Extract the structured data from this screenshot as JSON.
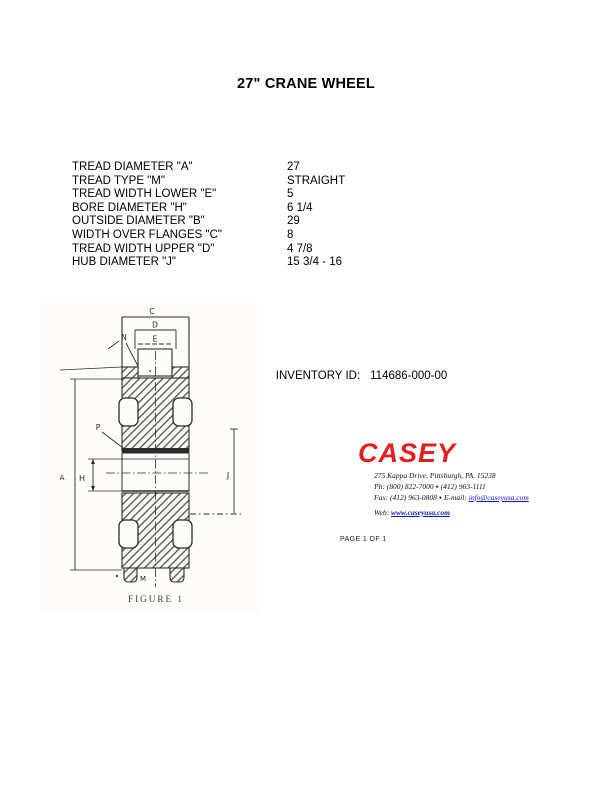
{
  "page": {
    "title": "27\" CRANE WHEEL",
    "page_label": "PAGE 1 OF 1"
  },
  "specs": {
    "rows": [
      {
        "label": "TREAD DIAMETER \"A\"",
        "value": "27"
      },
      {
        "label": "TREAD TYPE \"M\"",
        "value": "STRAIGHT"
      },
      {
        "label": "TREAD WIDTH LOWER \"E\"",
        "value": "5"
      },
      {
        "label": "BORE DIAMETER \"H\"",
        "value": "6 1/4"
      },
      {
        "label": "OUTSIDE DIAMETER \"B\"",
        "value": "29"
      },
      {
        "label": "WIDTH OVER FLANGES \"C\"",
        "value": "8"
      },
      {
        "label": "TREAD WIDTH UPPER \"D\"",
        "value": "4 7/8"
      },
      {
        "label": "HUB DIAMETER \"J\"",
        "value": "15 3/4 - 16"
      }
    ]
  },
  "inventory": {
    "label": "INVENTORY ID:",
    "value": "114686-000-00"
  },
  "figure": {
    "caption": "FIGURE  1",
    "labels": {
      "c": "C",
      "d": "D",
      "e": "E",
      "n": "N",
      "p": "P",
      "a": "A",
      "h": "H",
      "j": "J",
      "m": "M"
    }
  },
  "company": {
    "name": "CASEY",
    "address": "275 Kappa Drive, Pittsburgh, PA. 15238",
    "phone_line": {
      "prefix": "Ph: (800) 822-7000",
      "separator": "●",
      "suffix": "(412) 963-1111"
    },
    "fax_line": {
      "prefix": "Fax: (412) 963-0808",
      "separator": "●",
      "email_label": "E-mail:",
      "email": "info@caseyusa.com"
    },
    "web_line": {
      "label": "Web:",
      "url": "www.caseyusa.com"
    },
    "brand_color": "#e3201b",
    "link_color": "#1414b8"
  }
}
